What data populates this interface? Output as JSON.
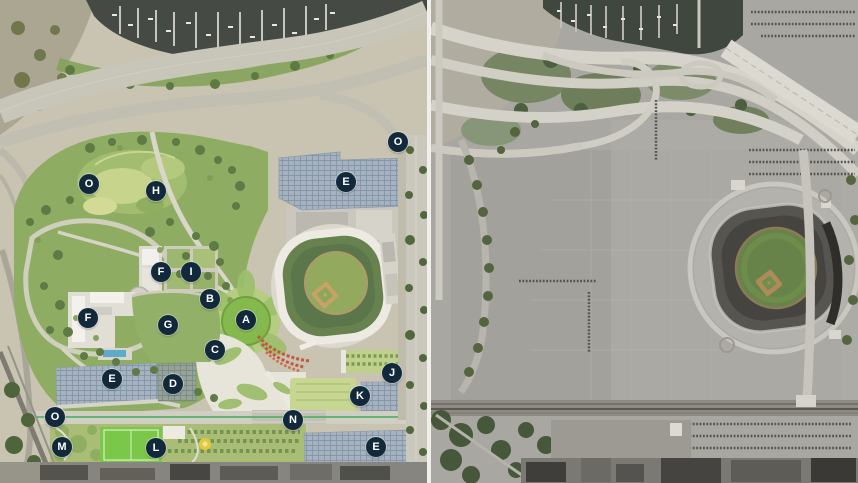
{
  "canvas": {
    "width": 858,
    "height": 483
  },
  "colors": {
    "marker_bg": "#12293c",
    "marker_text": "#ffffff",
    "divider": "#f0efec",
    "plan_park_green": "#8fac63",
    "plan_solar_roof": "#a6b2bf",
    "plan_water": "#454b44",
    "aerial_parking_gray": "#a9a7a1",
    "aerial_field_green": "#678349"
  },
  "left_panel": {
    "markers": [
      {
        "letter": "O",
        "x": 89,
        "y": 184
      },
      {
        "letter": "H",
        "x": 156,
        "y": 191
      },
      {
        "letter": "E",
        "x": 346,
        "y": 182
      },
      {
        "letter": "O",
        "x": 398,
        "y": 142
      },
      {
        "letter": "F",
        "x": 161,
        "y": 272
      },
      {
        "letter": "I",
        "x": 191,
        "y": 272
      },
      {
        "letter": "B",
        "x": 210,
        "y": 299
      },
      {
        "letter": "F",
        "x": 88,
        "y": 318
      },
      {
        "letter": "G",
        "x": 168,
        "y": 325
      },
      {
        "letter": "A",
        "x": 246,
        "y": 320
      },
      {
        "letter": "C",
        "x": 215,
        "y": 350
      },
      {
        "letter": "E",
        "x": 112,
        "y": 379
      },
      {
        "letter": "D",
        "x": 173,
        "y": 384
      },
      {
        "letter": "J",
        "x": 392,
        "y": 373
      },
      {
        "letter": "K",
        "x": 360,
        "y": 396
      },
      {
        "letter": "N",
        "x": 293,
        "y": 420
      },
      {
        "letter": "O",
        "x": 55,
        "y": 417
      },
      {
        "letter": "M",
        "x": 62,
        "y": 447
      },
      {
        "letter": "L",
        "x": 156,
        "y": 448
      },
      {
        "letter": "E",
        "x": 376,
        "y": 447
      }
    ]
  },
  "right_panel": {
    "markers": []
  }
}
